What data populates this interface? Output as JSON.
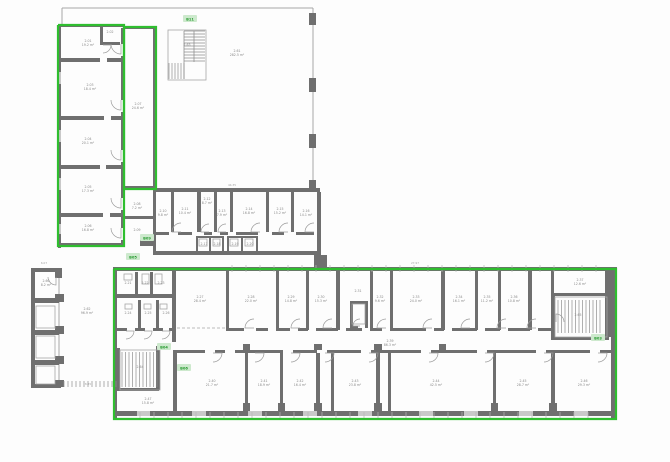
{
  "meta": {
    "bg": "#fdfdfd",
    "wall_color": "#6f6f6f",
    "dark_wall_color": "#585858",
    "thin_color": "#a6a6a6",
    "green_color": "#2fbe2f",
    "tag_bg_color": "#cde9cd",
    "tag_text_color": "#259a2e",
    "label_color": "#8a8a8a"
  },
  "green_outlines": [
    [
      [
        58,
        25
      ],
      [
        124,
        25
      ],
      [
        124,
        246
      ],
      [
        58,
        246
      ],
      [
        58,
        25
      ]
    ],
    [
      [
        124,
        27
      ],
      [
        156,
        27
      ],
      [
        156,
        189
      ],
      [
        124,
        189
      ],
      [
        124,
        27
      ]
    ],
    [
      [
        114,
        269
      ],
      [
        616,
        269
      ],
      [
        616,
        419
      ],
      [
        114,
        419
      ],
      [
        114,
        269
      ]
    ]
  ],
  "walls": [
    [
      58,
      24,
      66,
      3
    ],
    [
      124,
      26,
      33,
      3
    ],
    [
      58,
      26,
      3,
      222
    ],
    [
      121,
      28,
      4,
      218
    ],
    [
      153,
      28,
      3,
      162
    ],
    [
      124,
      186,
      32,
      4
    ],
    [
      58,
      243,
      66,
      4
    ],
    [
      100,
      26,
      3,
      18
    ],
    [
      100,
      42,
      20,
      3
    ],
    [
      58,
      58,
      42,
      4
    ],
    [
      107,
      58,
      17,
      4
    ],
    [
      58,
      116,
      46,
      4
    ],
    [
      111,
      116,
      13,
      4
    ],
    [
      58,
      165,
      42,
      4
    ],
    [
      106,
      165,
      18,
      4
    ],
    [
      58,
      213,
      45,
      4
    ],
    [
      110,
      213,
      14,
      4
    ],
    [
      309,
      13,
      7,
      12
    ],
    [
      309,
      78,
      7,
      14
    ],
    [
      309,
      134,
      7,
      14
    ],
    [
      309,
      180,
      7,
      10
    ],
    [
      153,
      188,
      167,
      4
    ],
    [
      124,
      216,
      30,
      3
    ],
    [
      153,
      190,
      3,
      64
    ],
    [
      171,
      192,
      3,
      40
    ],
    [
      197,
      192,
      4,
      40
    ],
    [
      214,
      192,
      3,
      40
    ],
    [
      230,
      192,
      3,
      40
    ],
    [
      266,
      192,
      3,
      40
    ],
    [
      291,
      192,
      3,
      40
    ],
    [
      155,
      232,
      14,
      3
    ],
    [
      178,
      232,
      14,
      3
    ],
    [
      204,
      232,
      8,
      3
    ],
    [
      220,
      232,
      8,
      3
    ],
    [
      236,
      232,
      22,
      3
    ],
    [
      272,
      232,
      12,
      3
    ],
    [
      296,
      232,
      18,
      3
    ],
    [
      196,
      236,
      2,
      16
    ],
    [
      209,
      236,
      2,
      16
    ],
    [
      222,
      236,
      2,
      16
    ],
    [
      196,
      236,
      28,
      2
    ],
    [
      227,
      236,
      2,
      16
    ],
    [
      241,
      236,
      2,
      16
    ],
    [
      256,
      236,
      2,
      16
    ],
    [
      227,
      236,
      31,
      2
    ],
    [
      153,
      251,
      167,
      4
    ],
    [
      317,
      192,
      4,
      63
    ],
    [
      314,
      255,
      13,
      14
    ],
    [
      140,
      240,
      15,
      6
    ],
    [
      31,
      268,
      31,
      4
    ],
    [
      31,
      270,
      4,
      118
    ],
    [
      31,
      384,
      30,
      4
    ],
    [
      33,
      298,
      26,
      5
    ],
    [
      33,
      330,
      26,
      5
    ],
    [
      33,
      360,
      26,
      5
    ],
    [
      55,
      294,
      9,
      8
    ],
    [
      55,
      326,
      9,
      8
    ],
    [
      55,
      356,
      9,
      8
    ],
    [
      55,
      380,
      9,
      7
    ],
    [
      55,
      270,
      7,
      8
    ],
    [
      113,
      267,
      504,
      4
    ],
    [
      611,
      270,
      5,
      148
    ],
    [
      113,
      270,
      4,
      148
    ],
    [
      116,
      411,
      501,
      5
    ],
    [
      135,
      272,
      3,
      24
    ],
    [
      150,
      272,
      3,
      24
    ],
    [
      115,
      294,
      60,
      4
    ],
    [
      138,
      300,
      3,
      30
    ],
    [
      156,
      300,
      3,
      30
    ],
    [
      172,
      270,
      4,
      72
    ],
    [
      117,
      328,
      10,
      3
    ],
    [
      135,
      328,
      10,
      3
    ],
    [
      153,
      328,
      10,
      3
    ],
    [
      169,
      328,
      6,
      3
    ],
    [
      117,
      348,
      3,
      42
    ],
    [
      156,
      346,
      4,
      44
    ],
    [
      117,
      388,
      42,
      3
    ],
    [
      173,
      350,
      4,
      63
    ],
    [
      226,
      270,
      3,
      60
    ],
    [
      276,
      270,
      3,
      60
    ],
    [
      306,
      270,
      3,
      60
    ],
    [
      336,
      270,
      4,
      60
    ],
    [
      370,
      270,
      3,
      60
    ],
    [
      390,
      270,
      3,
      60
    ],
    [
      441,
      270,
      4,
      60
    ],
    [
      475,
      270,
      3,
      60
    ],
    [
      498,
      270,
      3,
      60
    ],
    [
      528,
      270,
      4,
      60
    ],
    [
      551,
      270,
      3,
      60
    ],
    [
      350,
      301,
      3,
      27
    ],
    [
      365,
      301,
      3,
      27
    ],
    [
      350,
      301,
      17,
      3
    ],
    [
      350,
      326,
      8,
      3
    ],
    [
      226,
      328,
      18,
      3
    ],
    [
      256,
      328,
      12,
      3
    ],
    [
      276,
      328,
      14,
      3
    ],
    [
      298,
      328,
      10,
      3
    ],
    [
      316,
      328,
      22,
      3
    ],
    [
      346,
      328,
      16,
      3
    ],
    [
      370,
      328,
      12,
      3
    ],
    [
      390,
      328,
      36,
      3
    ],
    [
      434,
      328,
      10,
      3
    ],
    [
      452,
      328,
      25,
      3
    ],
    [
      485,
      328,
      15,
      3
    ],
    [
      508,
      328,
      22,
      3
    ],
    [
      538,
      328,
      15,
      3
    ],
    [
      551,
      293,
      4,
      47
    ],
    [
      551,
      293,
      58,
      3
    ],
    [
      551,
      337,
      58,
      3
    ],
    [
      605,
      270,
      6,
      67
    ],
    [
      177,
      350,
      28,
      3
    ],
    [
      215,
      350,
      10,
      3
    ],
    [
      235,
      350,
      48,
      3
    ],
    [
      293,
      350,
      24,
      3
    ],
    [
      327,
      350,
      34,
      3
    ],
    [
      371,
      350,
      50,
      3
    ],
    [
      431,
      350,
      46,
      3
    ],
    [
      487,
      350,
      49,
      3
    ],
    [
      546,
      350,
      44,
      3
    ],
    [
      600,
      350,
      12,
      3
    ],
    [
      245,
      353,
      3,
      58
    ],
    [
      280,
      353,
      3,
      58
    ],
    [
      316,
      353,
      4,
      58
    ],
    [
      331,
      353,
      3,
      58
    ],
    [
      376,
      353,
      4,
      58
    ],
    [
      388,
      353,
      3,
      58
    ],
    [
      493,
      353,
      3,
      58
    ],
    [
      551,
      353,
      4,
      58
    ],
    [
      243,
      403,
      7,
      8
    ],
    [
      278,
      403,
      7,
      8
    ],
    [
      314,
      403,
      8,
      8
    ],
    [
      374,
      403,
      8,
      8
    ],
    [
      491,
      403,
      7,
      8
    ],
    [
      549,
      403,
      8,
      8
    ],
    [
      243,
      344,
      7,
      6
    ],
    [
      314,
      344,
      8,
      6
    ],
    [
      374,
      344,
      8,
      6
    ],
    [
      439,
      344,
      7,
      6
    ]
  ],
  "gaps": [
    [
      121,
      44,
      4,
      12
    ],
    [
      121,
      100,
      4,
      12
    ],
    [
      121,
      150,
      4,
      12
    ],
    [
      121,
      198,
      4,
      12
    ],
    [
      121,
      228,
      4,
      12
    ]
  ],
  "windows": [
    [
      58,
      72,
      3,
      12
    ],
    [
      58,
      130,
      3,
      12
    ],
    [
      58,
      178,
      3,
      12
    ],
    [
      58,
      224,
      3,
      10
    ],
    [
      137,
      411,
      13,
      5
    ],
    [
      192,
      411,
      14,
      5
    ],
    [
      248,
      411,
      14,
      5
    ],
    [
      303,
      411,
      14,
      5
    ],
    [
      358,
      411,
      14,
      5
    ],
    [
      419,
      411,
      14,
      5
    ],
    [
      464,
      411,
      14,
      5
    ],
    [
      519,
      411,
      14,
      5
    ],
    [
      574,
      411,
      14,
      5
    ]
  ],
  "lines": [
    [
      62,
      8,
      313,
      8
    ],
    [
      62,
      8,
      62,
      24
    ],
    [
      313,
      8,
      313,
      190
    ],
    [
      184,
      31,
      184,
      79
    ],
    [
      194,
      31,
      194,
      62
    ],
    [
      59,
      272,
      59,
      384
    ]
  ],
  "dashes": [
    [
      177,
      328,
      226,
      328
    ]
  ],
  "srects": [
    [
      168,
      30,
      38,
      50
    ],
    [
      120,
      350,
      40,
      40
    ],
    [
      555,
      297,
      52,
      40
    ],
    [
      36,
      306,
      19,
      22
    ],
    [
      36,
      336,
      19,
      22
    ],
    [
      36,
      366,
      19,
      18
    ],
    [
      124,
      274,
      8,
      6
    ],
    [
      142,
      274,
      7,
      10
    ],
    [
      155,
      274,
      7,
      10
    ],
    [
      125,
      304,
      7,
      5
    ],
    [
      144,
      304,
      7,
      5
    ],
    [
      160,
      304,
      7,
      5
    ],
    [
      199,
      239,
      8,
      7
    ],
    [
      213,
      239,
      7,
      7
    ],
    [
      230,
      239,
      8,
      7
    ],
    [
      245,
      239,
      8,
      7
    ],
    [
      352,
      304,
      13,
      20
    ]
  ],
  "stairs": [
    {
      "x": 184,
      "y": 31,
      "w": 21,
      "h": 31,
      "dir": "h",
      "step": 3
    },
    {
      "x": 169,
      "y": 63,
      "w": 16,
      "h": 16,
      "dir": "v",
      "step": 3
    },
    {
      "x": 122,
      "y": 352,
      "w": 36,
      "h": 35,
      "dir": "v",
      "step": 3.5
    },
    {
      "x": 558,
      "y": 300,
      "w": 42,
      "h": 33,
      "dir": "v",
      "step": 3.5
    },
    {
      "x": 64,
      "y": 381,
      "w": 53,
      "h": 6,
      "dir": "v",
      "step": 4
    }
  ],
  "doors": [
    [
      121,
      44,
      10,
      90
    ],
    [
      121,
      100,
      10,
      90
    ],
    [
      121,
      150,
      10,
      90
    ],
    [
      121,
      198,
      10,
      90
    ],
    [
      121,
      228,
      10,
      90
    ],
    [
      103,
      45,
      8,
      0
    ],
    [
      56,
      277,
      8,
      90
    ],
    [
      126,
      331,
      8,
      0
    ],
    [
      144,
      331,
      8,
      0
    ],
    [
      162,
      331,
      8,
      0
    ],
    [
      181,
      232,
      9,
      180
    ],
    [
      209,
      232,
      8,
      180
    ],
    [
      226,
      232,
      8,
      180
    ],
    [
      260,
      232,
      9,
      180
    ],
    [
      288,
      232,
      9,
      180
    ],
    [
      314,
      232,
      9,
      180
    ],
    [
      254,
      328,
      9,
      180
    ],
    [
      300,
      328,
      9,
      180
    ],
    [
      332,
      328,
      9,
      180
    ],
    [
      386,
      328,
      9,
      180
    ],
    [
      432,
      328,
      9,
      180
    ],
    [
      470,
      328,
      9,
      180
    ],
    [
      506,
      328,
      9,
      180
    ],
    [
      536,
      328,
      9,
      180
    ],
    [
      360,
      326,
      7,
      180
    ],
    [
      556,
      322,
      8,
      270
    ],
    [
      213,
      353,
      9,
      0
    ],
    [
      255,
      353,
      9,
      0
    ],
    [
      291,
      353,
      9,
      0
    ],
    [
      325,
      353,
      9,
      0
    ],
    [
      369,
      353,
      9,
      0
    ],
    [
      429,
      353,
      9,
      0
    ],
    [
      485,
      353,
      9,
      0
    ],
    [
      544,
      353,
      9,
      0
    ],
    [
      598,
      353,
      9,
      0
    ]
  ],
  "ticks": [
    {
      "x0": 232,
      "x1": 606,
      "y0": 265,
      "y1": 272,
      "step": 14
    },
    {
      "x0": 140,
      "x1": 600,
      "y0": 412,
      "y1": 418,
      "step": 14
    }
  ],
  "tags": [
    {
      "x": 190,
      "y": 19,
      "text": "B11"
    },
    {
      "x": 133,
      "y": 257,
      "text": "B05"
    },
    {
      "x": 147,
      "y": 238,
      "text": "B09"
    },
    {
      "x": 164,
      "y": 347,
      "text": "B04"
    },
    {
      "x": 184,
      "y": 368,
      "text": "B06"
    },
    {
      "x": 598,
      "y": 338,
      "text": "B03"
    }
  ],
  "labels": [
    {
      "x": 88,
      "y": 42,
      "l": [
        "2.01",
        "19.2 m²"
      ]
    },
    {
      "x": 110,
      "y": 33,
      "l": [
        "2.02"
      ]
    },
    {
      "x": 90,
      "y": 86,
      "l": [
        "2.03",
        "18.4 m²"
      ]
    },
    {
      "x": 88,
      "y": 140,
      "l": [
        "2.04",
        "20.1 m²"
      ]
    },
    {
      "x": 88,
      "y": 188,
      "l": [
        "2.05",
        "17.3 m²"
      ]
    },
    {
      "x": 88,
      "y": 227,
      "l": [
        "2.06",
        "16.8 m²"
      ]
    },
    {
      "x": 138,
      "y": 105,
      "l": [
        "2.07",
        "24.6 m²"
      ]
    },
    {
      "x": 237,
      "y": 52,
      "l": [
        "2.61",
        "282.5 m²"
      ]
    },
    {
      "x": 187,
      "y": 46,
      "l": [
        "2.63"
      ]
    },
    {
      "x": 137,
      "y": 205,
      "l": [
        "2.08",
        "7.2 m²"
      ]
    },
    {
      "x": 137,
      "y": 231,
      "l": [
        "2.09"
      ]
    },
    {
      "x": 163,
      "y": 212,
      "l": [
        "2.10",
        "9.8 m²"
      ]
    },
    {
      "x": 185,
      "y": 210,
      "l": [
        "2.11",
        "10.4 m²"
      ]
    },
    {
      "x": 207,
      "y": 200,
      "l": [
        "2.12",
        "8.7 m²"
      ]
    },
    {
      "x": 222,
      "y": 212,
      "l": [
        "2.13",
        "7.9 m²"
      ]
    },
    {
      "x": 249,
      "y": 210,
      "l": [
        "2.14",
        "16.8 m²"
      ]
    },
    {
      "x": 280,
      "y": 210,
      "l": [
        "2.15",
        "15.2 m²"
      ]
    },
    {
      "x": 306,
      "y": 212,
      "l": [
        "2.16",
        "14.1 m²"
      ]
    },
    {
      "x": 204,
      "y": 245,
      "l": [
        "2.17"
      ]
    },
    {
      "x": 217,
      "y": 245,
      "l": [
        "2.18"
      ]
    },
    {
      "x": 235,
      "y": 245,
      "l": [
        "2.19"
      ]
    },
    {
      "x": 250,
      "y": 245,
      "l": [
        "2.20"
      ]
    },
    {
      "x": 46,
      "y": 282,
      "l": [
        "2.60",
        "8.2 m²"
      ]
    },
    {
      "x": 87,
      "y": 310,
      "l": [
        "2.62",
        "96.9 m²"
      ]
    },
    {
      "x": 128,
      "y": 284,
      "l": [
        "2.21"
      ]
    },
    {
      "x": 145,
      "y": 284,
      "l": [
        "2.22"
      ]
    },
    {
      "x": 161,
      "y": 284,
      "l": [
        "2.23"
      ]
    },
    {
      "x": 128,
      "y": 314,
      "l": [
        "2.24"
      ]
    },
    {
      "x": 148,
      "y": 314,
      "l": [
        "2.25"
      ]
    },
    {
      "x": 166,
      "y": 314,
      "l": [
        "2.26"
      ]
    },
    {
      "x": 200,
      "y": 298,
      "l": [
        "2.27",
        "28.4 m²"
      ]
    },
    {
      "x": 251,
      "y": 298,
      "l": [
        "2.28",
        "22.0 m²"
      ]
    },
    {
      "x": 291,
      "y": 298,
      "l": [
        "2.29",
        "14.8 m²"
      ]
    },
    {
      "x": 321,
      "y": 298,
      "l": [
        "2.30",
        "15.3 m²"
      ]
    },
    {
      "x": 358,
      "y": 292,
      "l": [
        "2.31"
      ]
    },
    {
      "x": 380,
      "y": 298,
      "l": [
        "2.32",
        "9.6 m²"
      ]
    },
    {
      "x": 416,
      "y": 298,
      "l": [
        "2.33",
        "24.0 m²"
      ]
    },
    {
      "x": 459,
      "y": 298,
      "l": [
        "2.34",
        "16.1 m²"
      ]
    },
    {
      "x": 487,
      "y": 298,
      "l": [
        "2.35",
        "11.2 m²"
      ]
    },
    {
      "x": 514,
      "y": 298,
      "l": [
        "2.36",
        "10.8 m²"
      ]
    },
    {
      "x": 580,
      "y": 281,
      "l": [
        "2.37",
        "12.6 m²"
      ]
    },
    {
      "x": 578,
      "y": 316,
      "l": [
        "2.65"
      ]
    },
    {
      "x": 390,
      "y": 342,
      "l": [
        "2.39",
        "86.3 m²"
      ]
    },
    {
      "x": 140,
      "y": 368,
      "l": [
        "2.64"
      ]
    },
    {
      "x": 212,
      "y": 382,
      "l": [
        "2.40",
        "21.7 m²"
      ]
    },
    {
      "x": 264,
      "y": 382,
      "l": [
        "2.41",
        "18.9 m²"
      ]
    },
    {
      "x": 300,
      "y": 382,
      "l": [
        "2.42",
        "16.4 m²"
      ]
    },
    {
      "x": 355,
      "y": 382,
      "l": [
        "2.43",
        "23.8 m²"
      ]
    },
    {
      "x": 436,
      "y": 382,
      "l": [
        "2.44",
        "42.5 m²"
      ]
    },
    {
      "x": 523,
      "y": 382,
      "l": [
        "2.45",
        "28.7 m²"
      ]
    },
    {
      "x": 584,
      "y": 382,
      "l": [
        "2.46",
        "29.3 m²"
      ]
    },
    {
      "x": 148,
      "y": 400,
      "l": [
        "2.47",
        "15.8 m²"
      ]
    }
  ],
  "dims": [
    {
      "x": 415,
      "y": 264,
      "t": "27.97"
    },
    {
      "x": 232,
      "y": 186,
      "t": "44.35"
    },
    {
      "x": 88,
      "y": 385,
      "t": "8.85"
    },
    {
      "x": 44,
      "y": 264,
      "t": "6.07"
    }
  ]
}
